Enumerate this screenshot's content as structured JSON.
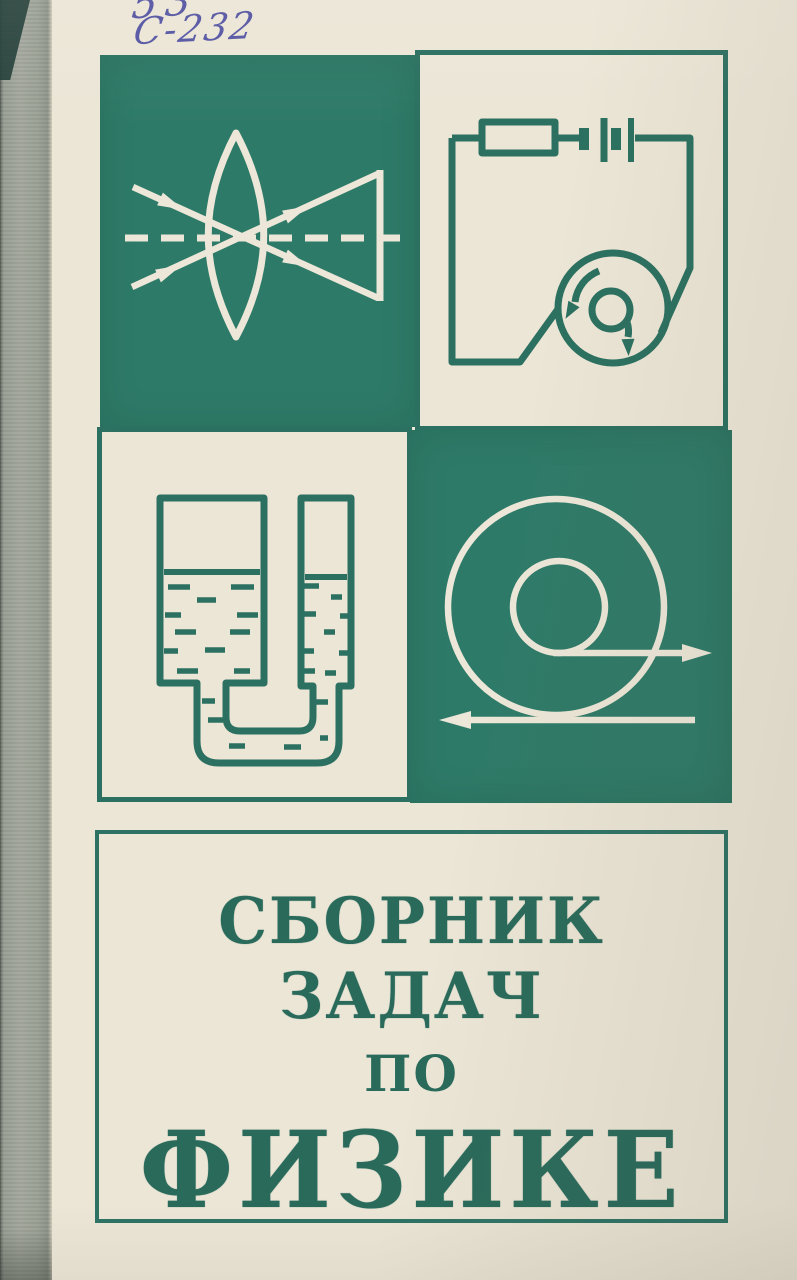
{
  "cover": {
    "library_marks": {
      "call_number_top": "53",
      "call_number_bottom": "С-232"
    },
    "title": {
      "line1": "СБОРНИК ЗАДАЧ",
      "line2": "ПО",
      "line3": "ФИЗИКЕ"
    },
    "panels": [
      {
        "icon": "converging-lens-ray-diagram-icon",
        "position": "top-left"
      },
      {
        "icon": "electric-circuit-with-coil-icon",
        "position": "top-right"
      },
      {
        "icon": "communicating-vessels-icon",
        "position": "bottom-left"
      },
      {
        "icon": "rolling-wheel-velocity-arrows-icon",
        "position": "bottom-right"
      }
    ],
    "colors": {
      "panel_teal": "#2e7a68",
      "line_teal": "#2b7060",
      "cover_cream": "#ece6d7",
      "title_text_teal": "#296a5b",
      "handwriting_ink_blue": "#42449c",
      "spine_gray": "#9ba195"
    }
  }
}
